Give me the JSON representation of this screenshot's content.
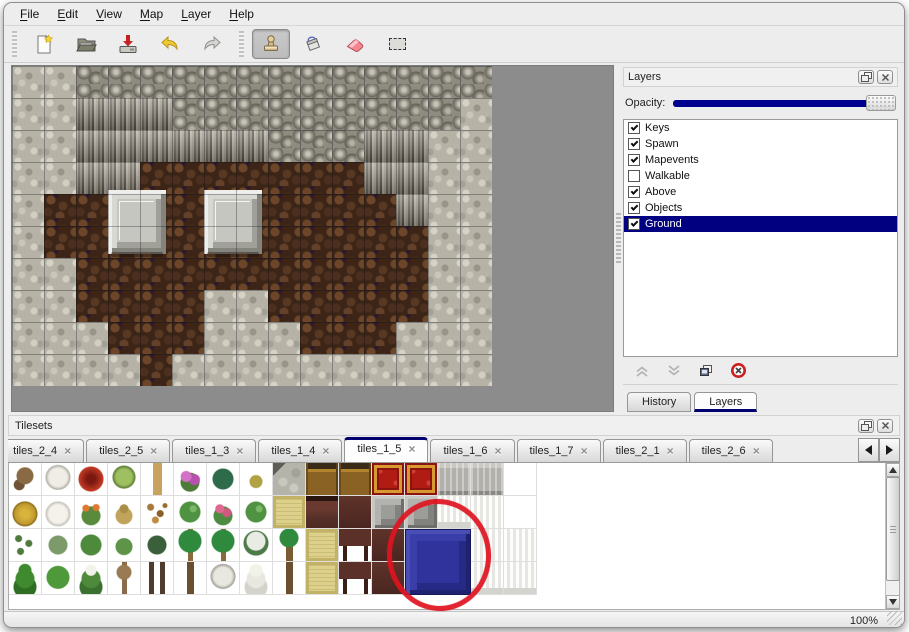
{
  "window": {
    "menu_items": [
      {
        "label": "File"
      },
      {
        "label": "Edit"
      },
      {
        "label": "View"
      },
      {
        "label": "Map"
      },
      {
        "label": "Layer"
      },
      {
        "label": "Help"
      }
    ],
    "status": {
      "zoom_level": "100%"
    }
  },
  "toolbar": {
    "buttons": [
      {
        "name": "new-file-icon"
      },
      {
        "name": "open-file-icon"
      },
      {
        "name": "save-file-icon"
      },
      {
        "name": "undo-icon"
      },
      {
        "name": "redo-icon"
      },
      {
        "name": "stamp-tool-icon",
        "active": true
      },
      {
        "name": "fill-tool-icon"
      },
      {
        "name": "eraser-tool-icon"
      },
      {
        "name": "select-tool-icon"
      }
    ]
  },
  "map": {
    "tile_size": 32,
    "legend": {
      "P": "pebble-ground",
      "K": "rock-top",
      "C": "cliff-face",
      "B": "brown-cobble-floor"
    },
    "rows": [
      "PPKKKKKKKKKKKKK",
      "PPCCCKKKKKKKKKP",
      "PPCCCCCCKKKCCPP",
      "PPCCBBBBBBBCCPP",
      "PBBBBBBBBBBBCPP",
      "PBBBBBBBBBBBBPP",
      "PPBBBBBBBBBBBPP",
      "PPBBBBPPBBBBBPP",
      "PPPBBBPPPBBBPPP",
      "PPPPBPPPPPPPPPP"
    ],
    "pillars": [
      {
        "x": 96,
        "y": 124
      },
      {
        "x": 192,
        "y": 124
      }
    ]
  },
  "layers_panel": {
    "title": "Layers",
    "opacity_label": "Opacity:",
    "opacity_fraction": 1,
    "layers": [
      {
        "name": "Keys",
        "checked": true,
        "selected": false
      },
      {
        "name": "Spawn",
        "checked": true,
        "selected": false
      },
      {
        "name": "Mapevents",
        "checked": true,
        "selected": false
      },
      {
        "name": "Walkable",
        "checked": false,
        "selected": false
      },
      {
        "name": "Above",
        "checked": true,
        "selected": false
      },
      {
        "name": "Objects",
        "checked": true,
        "selected": false
      },
      {
        "name": "Ground",
        "checked": true,
        "selected": true
      }
    ],
    "buttons": [
      "move-layer-up",
      "move-layer-down",
      "duplicate-layer",
      "delete-layer"
    ],
    "dock_tabs": [
      {
        "label": "History",
        "active": false
      },
      {
        "label": "Layers",
        "active": true
      }
    ]
  },
  "tilesets_panel": {
    "title": "Tilesets",
    "tab_close_glyph": "×",
    "tabs": [
      {
        "label": "3",
        "active": false,
        "clipped": true
      },
      {
        "label": "tiles_2_4",
        "active": false
      },
      {
        "label": "tiles_2_5",
        "active": false
      },
      {
        "label": "tiles_1_3",
        "active": false
      },
      {
        "label": "tiles_1_4",
        "active": false
      },
      {
        "label": "tiles_1_5",
        "active": true
      },
      {
        "label": "tiles_1_6",
        "active": false
      },
      {
        "label": "tiles_1_7",
        "active": false
      },
      {
        "label": "tiles_2_1",
        "active": false
      },
      {
        "label": "tiles_2_6",
        "active": false
      }
    ],
    "palette_grid": [
      [
        "dead-tree",
        "snow-tree",
        "red-flower",
        "stump",
        "trunk",
        "pink-flowers",
        "fern",
        "herb",
        "stone-corner",
        "wood-top",
        "wood-top",
        "red-carpet",
        "red-carpet",
        "gray-tile",
        "gray-tile",
        "empty"
      ],
      [
        "hay-mound",
        "snow-mound",
        "orange-flowers",
        "dry-grass",
        "leaves",
        "lily-pad",
        "roses",
        "lily-pad",
        "tatami",
        "maroon-dark",
        "maroon",
        "gray-blocks",
        "gray-blocks",
        "curtain-fringe",
        "curtain",
        "empty"
      ],
      [
        "sprouts",
        "bush-gray",
        "bush",
        "bush-small",
        "bush-dark",
        "palm",
        "palm",
        "snow-palm",
        "palm-tall",
        "tatami",
        "maroon-legs",
        "maroon",
        "blue",
        "blue",
        "curtain",
        "curtain"
      ],
      [
        "conifer",
        "round-tree",
        "snow-conifer",
        "bare-tree",
        "dark-trunks",
        "palm-trunk",
        "snow-tree-2",
        "snow-fir",
        "palm-trunk",
        "tatami",
        "maroon-legs",
        "maroon",
        "blue",
        "blue",
        "curtain-fringe",
        "curtain-fringe"
      ]
    ],
    "selected_tile": {
      "name": "blue-panel-tile",
      "col": 12,
      "row": 2,
      "span": 2
    },
    "annotation": {
      "type": "hand-drawn-red-circle",
      "color": "#e0131f",
      "target": "blue-panel-tile"
    }
  },
  "colors": {
    "selection_navy": "#000080",
    "slider_navy": "#00008f",
    "annotation_red": "#e0131f",
    "canvas_gray": "#8c8c8c"
  }
}
